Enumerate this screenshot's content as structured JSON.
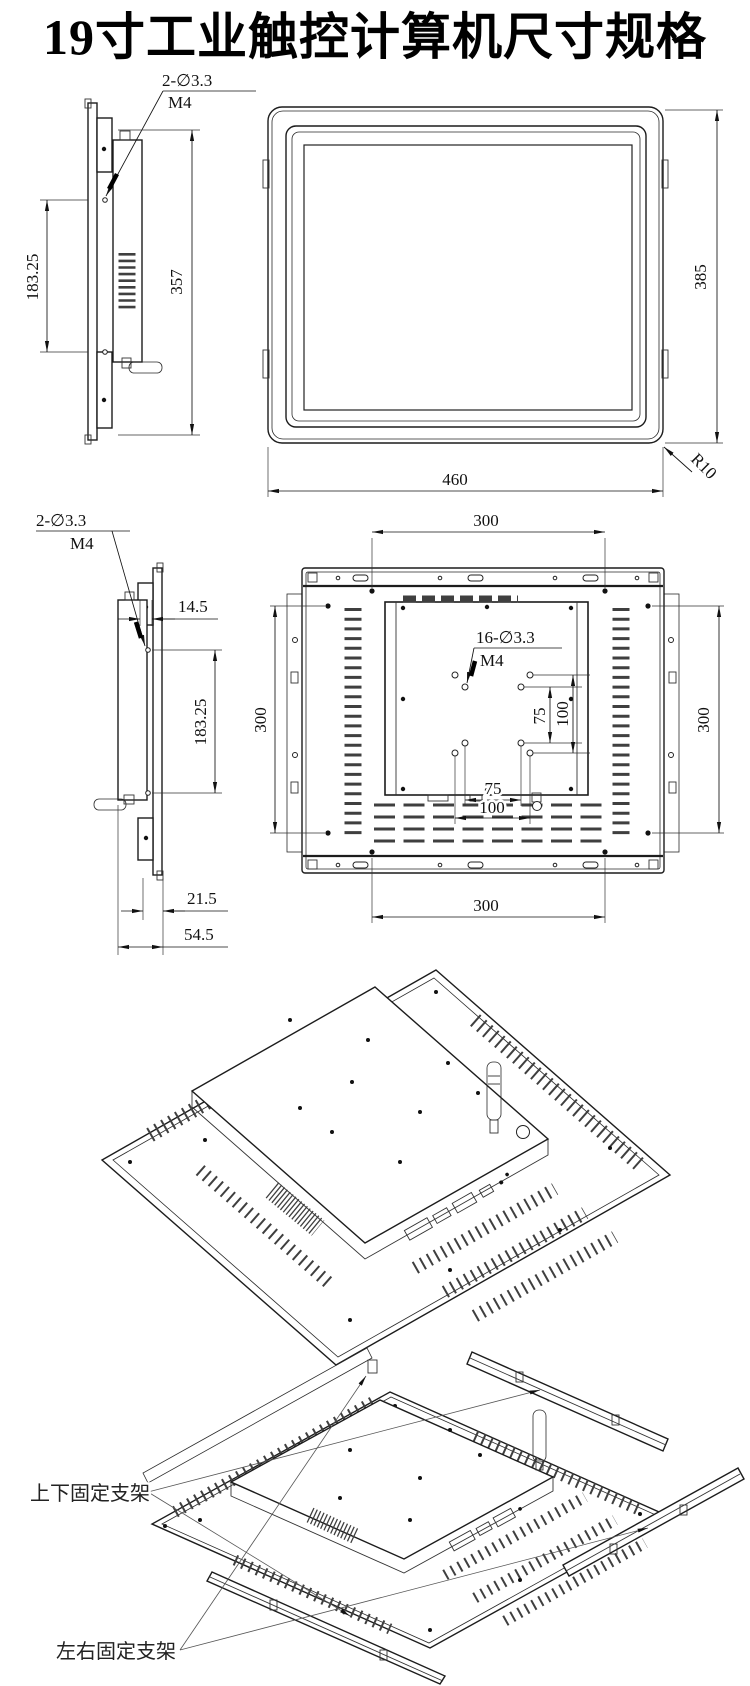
{
  "title": "19寸工业触控计算机尺寸规格",
  "front_section": {
    "side_hole_label": "2-∅3.3",
    "side_hole_thread": "M4",
    "hole_spacing": "183.25",
    "mount_height": "357",
    "overall_height": "385",
    "overall_width": "460",
    "corner_radius": "R10"
  },
  "rear_section": {
    "side_hole_label": "2-∅3.3",
    "side_hole_thread": "M4",
    "bezel_depth": "14.5",
    "hole_spacing": "183.25",
    "top_span": "300",
    "left_span": "300",
    "right_span": "300",
    "bottom_span": "300",
    "vesa_hole_label": "16-∅3.3",
    "vesa_hole_thread": "M4",
    "vesa_v75": "75",
    "vesa_v100": "100",
    "vesa_h75": "75",
    "vesa_h100": "100",
    "depth_inner": "21.5",
    "depth_total": "54.5"
  },
  "exploded_section": {
    "top_bottom_bracket_label": "上下固定支架",
    "left_right_bracket_label": "左右固定支架"
  }
}
